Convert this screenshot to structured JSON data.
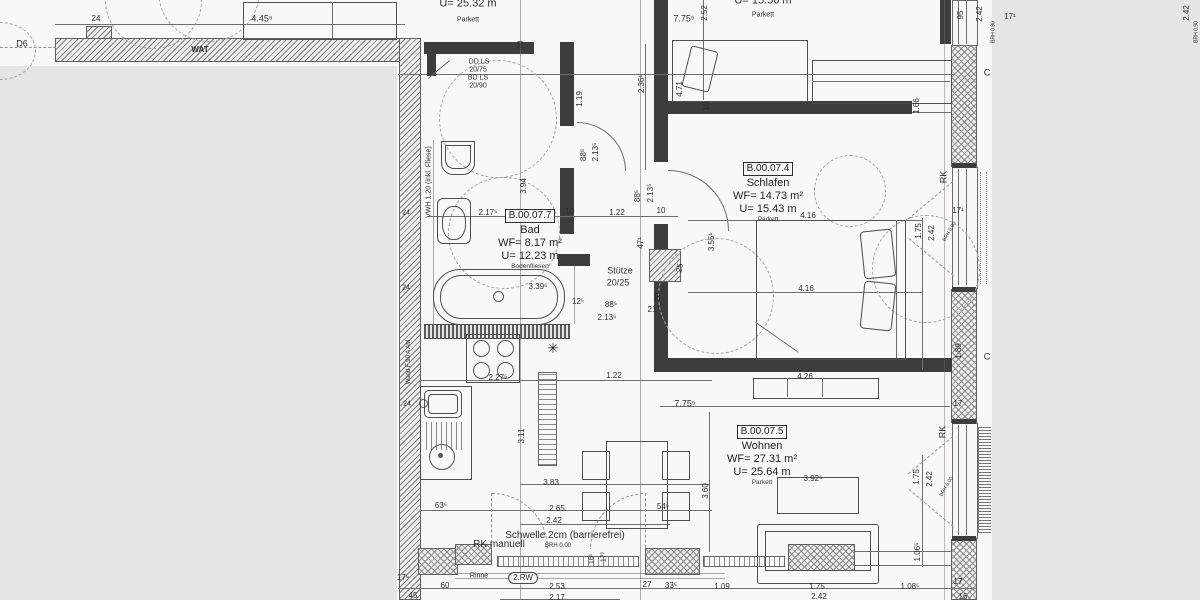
{
  "colors": {
    "paper": "#f9f8f6",
    "background": "#e7e5e2",
    "wall": "#3d3d3d",
    "line": "#6e6e6e"
  },
  "rooms": [
    {
      "id": "B.00.07.7",
      "name": "Bad",
      "area": "WF= 8.17 m²",
      "perimeter": "U= 12.23 m",
      "floor": "Bodenfliesen"
    },
    {
      "id": "B.00.07.4",
      "name": "Schlafen",
      "area": "WF= 14.73 m²",
      "perimeter": "U= 15.43 m",
      "floor": "Parkett"
    },
    {
      "id": "B.00.07.5",
      "name": "Wohnen",
      "area": "WF= 27.31 m²",
      "perimeter": "U= 25.64 m",
      "floor": "Parkett"
    }
  ],
  "annotations": [
    {
      "t": "D6",
      "x": 22,
      "y": 44,
      "s": 9
    },
    {
      "t": "24",
      "x": 96,
      "y": 19,
      "s": 8
    },
    {
      "t": "4.45⁵",
      "x": 262,
      "y": 19,
      "s": 9
    },
    {
      "t": "WAT",
      "x": 200,
      "y": 50,
      "s": 8,
      "b": 1
    },
    {
      "t": "U= 25.32 m",
      "x": 468,
      "y": 4,
      "s": 11
    },
    {
      "t": "Parkett",
      "x": 468,
      "y": 20,
      "s": 7
    },
    {
      "t": "7.75⁵",
      "x": 684,
      "y": 19,
      "s": 9
    },
    {
      "t": "2.52",
      "x": 705,
      "y": 13,
      "r": -90,
      "s": 8
    },
    {
      "t": "U= 15.56 m",
      "x": 763,
      "y": 1,
      "s": 11
    },
    {
      "t": "Parkett",
      "x": 763,
      "y": 15,
      "s": 7
    },
    {
      "t": "95",
      "x": 961,
      "y": 15,
      "r": -90,
      "s": 8
    },
    {
      "t": "2.42",
      "x": 980,
      "y": 14,
      "r": -90,
      "s": 8
    },
    {
      "t": "BRH 0.90",
      "x": 994,
      "y": 32,
      "r": -90,
      "s": 5
    },
    {
      "t": "17¹",
      "x": 1010,
      "y": 17,
      "s": 8
    },
    {
      "t": "2.42",
      "x": 1187,
      "y": 13,
      "r": -90,
      "s": 8
    },
    {
      "t": "BRH 0.90",
      "x": 1197,
      "y": 32,
      "r": -90,
      "s": 5
    },
    {
      "t": "DD LS",
      "x": 479,
      "y": 62,
      "s": 7
    },
    {
      "t": "20/75",
      "x": 478,
      "y": 70,
      "s": 7
    },
    {
      "t": "BD LS",
      "x": 478,
      "y": 78,
      "s": 7
    },
    {
      "t": "20/90",
      "x": 478,
      "y": 86,
      "s": 7
    },
    {
      "t": "10",
      "x": 521,
      "y": 45,
      "r": -90,
      "s": 8
    },
    {
      "t": "1.19",
      "x": 580,
      "y": 99,
      "r": -90,
      "s": 8
    },
    {
      "t": "2.36¹",
      "x": 642,
      "y": 84,
      "r": -90,
      "s": 8
    },
    {
      "t": "4.71",
      "x": 680,
      "y": 89,
      "r": -90,
      "s": 8
    },
    {
      "t": "10",
      "x": 707,
      "y": 106,
      "r": -90,
      "s": 8
    },
    {
      "t": "1.66",
      "x": 917,
      "y": 106,
      "r": -90,
      "s": 8
    },
    {
      "t": "3.94",
      "x": 524,
      "y": 186,
      "r": -90,
      "s": 8
    },
    {
      "t": "88⁵",
      "x": 584,
      "y": 155,
      "r": -90,
      "s": 8
    },
    {
      "t": "2.13⁵",
      "x": 596,
      "y": 152,
      "r": -90,
      "s": 8
    },
    {
      "t": "2.17⁵",
      "x": 488,
      "y": 213,
      "s": 8
    },
    {
      "t": "10",
      "x": 570,
      "y": 212,
      "s": 8
    },
    {
      "t": "1.22",
      "x": 617,
      "y": 213,
      "s": 8
    },
    {
      "t": "88⁵",
      "x": 638,
      "y": 196,
      "r": -90,
      "s": 8
    },
    {
      "t": "2.13⁵",
      "x": 651,
      "y": 193,
      "r": -90,
      "s": 8
    },
    {
      "t": "10",
      "x": 661,
      "y": 211,
      "s": 8
    },
    {
      "t": "3.39⁵",
      "x": 538,
      "y": 287,
      "s": 8
    },
    {
      "t": "47¹",
      "x": 641,
      "y": 243,
      "r": -90,
      "s": 8
    },
    {
      "t": "Stütze",
      "x": 620,
      "y": 271,
      "s": 9
    },
    {
      "t": "20/25",
      "x": 618,
      "y": 283,
      "s": 9
    },
    {
      "t": "25",
      "x": 680,
      "y": 268,
      "r": -80,
      "s": 8
    },
    {
      "t": "20",
      "x": 658,
      "y": 297,
      "r": -90,
      "s": 8
    },
    {
      "t": "21",
      "x": 652,
      "y": 310,
      "s": 8
    },
    {
      "t": "12⁵",
      "x": 578,
      "y": 302,
      "s": 8
    },
    {
      "t": "88⁵",
      "x": 611,
      "y": 305,
      "s": 8
    },
    {
      "t": "2.13⁵",
      "x": 607,
      "y": 318,
      "s": 8
    },
    {
      "t": "3.55¹",
      "x": 712,
      "y": 242,
      "r": -90,
      "s": 8
    },
    {
      "t": "4.16",
      "x": 808,
      "y": 216,
      "s": 8
    },
    {
      "t": "4.16",
      "x": 806,
      "y": 289,
      "s": 8
    },
    {
      "t": "1.75",
      "x": 919,
      "y": 231,
      "r": -90,
      "s": 8
    },
    {
      "t": "2.42",
      "x": 932,
      "y": 233,
      "r": -90,
      "s": 8
    },
    {
      "t": "RK",
      "x": 944,
      "y": 177,
      "r": -90,
      "s": 9
    },
    {
      "t": "17¹",
      "x": 958,
      "y": 211,
      "s": 8
    },
    {
      "t": "BRH 0.90",
      "x": 950,
      "y": 232,
      "r": -60,
      "s": 5
    },
    {
      "t": "1.89",
      "x": 959,
      "y": 351,
      "r": -90,
      "s": 8
    },
    {
      "t": "4.26",
      "x": 805,
      "y": 377,
      "s": 8
    },
    {
      "t": "C",
      "x": 987,
      "y": 73,
      "s": 9
    },
    {
      "t": "C",
      "x": 987,
      "y": 357,
      "s": 9
    },
    {
      "t": "2.27⁵",
      "x": 498,
      "y": 378,
      "s": 8
    },
    {
      "t": "1.22",
      "x": 614,
      "y": 376,
      "s": 8
    },
    {
      "t": "7.75⁵",
      "x": 685,
      "y": 404,
      "s": 9
    },
    {
      "t": "3.11",
      "x": 522,
      "y": 436,
      "r": -90,
      "s": 8
    },
    {
      "t": "3.83",
      "x": 551,
      "y": 483,
      "s": 8
    },
    {
      "t": "63⁵",
      "x": 441,
      "y": 506,
      "s": 8
    },
    {
      "t": "2.65",
      "x": 557,
      "y": 509,
      "s": 8
    },
    {
      "t": "2.42",
      "x": 554,
      "y": 521,
      "s": 8
    },
    {
      "t": "54⁵",
      "x": 663,
      "y": 507,
      "s": 8
    },
    {
      "t": "3.60",
      "x": 706,
      "y": 491,
      "r": -90,
      "s": 8
    },
    {
      "t": "3.92⁵",
      "x": 813,
      "y": 479,
      "s": 8
    },
    {
      "t": "RK",
      "x": 943,
      "y": 432,
      "r": -90,
      "s": 9
    },
    {
      "t": "1.75",
      "x": 917,
      "y": 477,
      "r": -90,
      "s": 8
    },
    {
      "t": "2.42",
      "x": 930,
      "y": 479,
      "r": -90,
      "s": 8
    },
    {
      "t": "BRH 0.00",
      "x": 947,
      "y": 487,
      "r": -60,
      "s": 5
    },
    {
      "t": "17",
      "x": 958,
      "y": 404,
      "s": 8
    },
    {
      "t": "1.06⁵",
      "x": 918,
      "y": 552,
      "r": -90,
      "s": 8
    },
    {
      "t": "1.09",
      "x": 722,
      "y": 587,
      "s": 8
    },
    {
      "t": "1.75",
      "x": 817,
      "y": 587,
      "s": 8
    },
    {
      "t": "2.42",
      "x": 819,
      "y": 597,
      "s": 8
    },
    {
      "t": "1.08⁵",
      "x": 910,
      "y": 587,
      "s": 8
    },
    {
      "t": "17",
      "x": 958,
      "y": 582,
      "s": 8
    },
    {
      "t": "16",
      "x": 963,
      "y": 597,
      "s": 8
    },
    {
      "t": "Schwelle 2cm (barrierefrei)",
      "x": 565,
      "y": 536,
      "s": 10
    },
    {
      "t": "RK manuell",
      "x": 499,
      "y": 545,
      "s": 10
    },
    {
      "t": "BRH 0.00",
      "x": 558,
      "y": 546,
      "s": 6
    },
    {
      "t": "Rinne",
      "x": 479,
      "y": 576,
      "s": 7
    },
    {
      "t": "2.RW",
      "x": 523,
      "y": 578,
      "s": 8,
      "oval": 1
    },
    {
      "t": "60",
      "x": 445,
      "y": 586,
      "s": 8
    },
    {
      "t": "2.53",
      "x": 557,
      "y": 587,
      "s": 8
    },
    {
      "t": "2.17",
      "x": 557,
      "y": 598,
      "s": 8
    },
    {
      "t": "27",
      "x": 647,
      "y": 585,
      "s": 8
    },
    {
      "t": "33⁵",
      "x": 671,
      "y": 586,
      "s": 8
    },
    {
      "t": "16¹",
      "x": 592,
      "y": 559,
      "r": -90,
      "s": 7
    },
    {
      "t": "17¹",
      "x": 604,
      "y": 557,
      "r": -90,
      "s": 7
    },
    {
      "t": "45",
      "x": 413,
      "y": 596,
      "s": 8
    },
    {
      "t": "17⁵",
      "x": 403,
      "y": 578,
      "s": 8
    },
    {
      "t": "VWH 1.20 (inkl. Fliese)",
      "x": 429,
      "y": 182,
      "r": -90,
      "s": 7
    },
    {
      "t": "24",
      "x": 406,
      "y": 213,
      "s": 7
    },
    {
      "t": "24",
      "x": 406,
      "y": 288,
      "s": 7
    },
    {
      "t": "24",
      "x": 407,
      "y": 404,
      "s": 7
    },
    {
      "t": "Wand F 90 A AM",
      "x": 409,
      "y": 362,
      "r": -90,
      "s": 6
    },
    {
      "t": "✳",
      "x": 553,
      "y": 348,
      "s": 14,
      "n": "lamp-symbol"
    }
  ]
}
